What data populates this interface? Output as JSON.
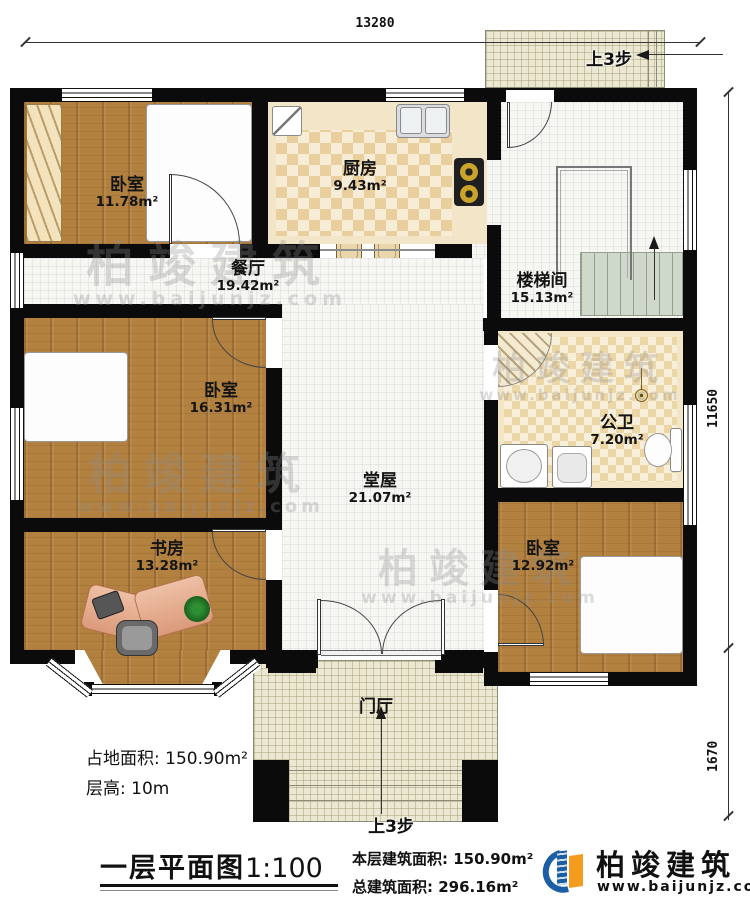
{
  "dimensions": {
    "top_width": "13280",
    "right_height": "11650",
    "porch_height": "1670"
  },
  "rooms": {
    "bedroom1": {
      "name": "卧室",
      "area": "11.78m²"
    },
    "kitchen": {
      "name": "厨房",
      "area": "9.43m²"
    },
    "stairwell": {
      "name": "楼梯间",
      "area": "15.13m²"
    },
    "dining": {
      "name": "餐厅",
      "area": "19.42m²"
    },
    "bedroom2": {
      "name": "卧室",
      "area": "16.31m²"
    },
    "bathroom": {
      "name": "公卫",
      "area": "7.20m²"
    },
    "hall": {
      "name": "堂屋",
      "area": "21.07m²"
    },
    "study": {
      "name": "书房",
      "area": "13.28m²"
    },
    "bedroom3": {
      "name": "卧室",
      "area": "12.92m²"
    },
    "foyer": {
      "name": "门厅"
    }
  },
  "annotations": {
    "steps_top": "上3步",
    "steps_bottom": "上3步",
    "site_area_label": "占地面积:",
    "site_area_value": "150.90m²",
    "floor_height_label": "层高:",
    "floor_height_value": "10m",
    "floor_area_label": "本层建筑面积:",
    "floor_area_value": "150.90m²",
    "total_area_label": "总建筑面积:",
    "total_area_value": "296.16m²"
  },
  "title": {
    "text": "一层平面图",
    "scale": "1:100"
  },
  "branding": {
    "company": "柏竣建筑",
    "website": "www.baijunjz.com"
  },
  "watermark": {
    "text": "柏竣建筑",
    "url": "www.baijunjz.com"
  },
  "colors": {
    "accent_blue": "#1b5ea6",
    "accent_orange": "#f39c1f",
    "wall": "#0b0b0b",
    "bed_blue": "#66bcd9"
  }
}
